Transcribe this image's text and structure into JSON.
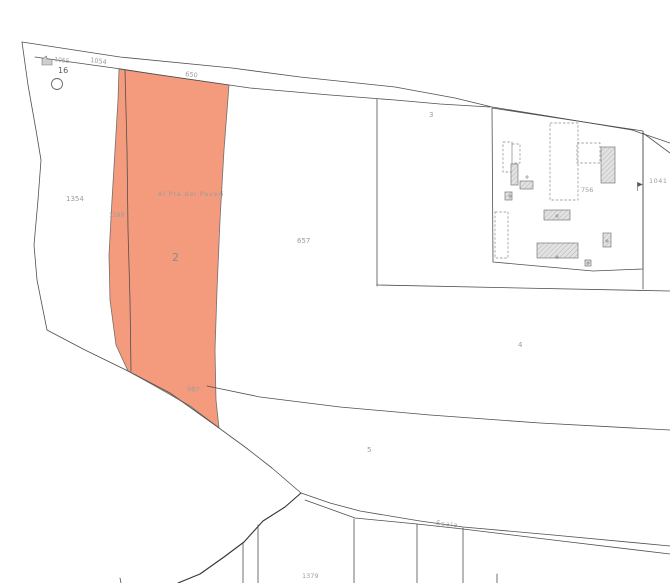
{
  "map": {
    "kind": "cadastral-parcel-map",
    "selected_parcel": "2",
    "toponym": "Al Pra del Paveri",
    "road_name": "Scala",
    "labels": {
      "p1055": "1055",
      "p16": "16",
      "p1054": "1054",
      "p650": "650",
      "p1354": "1354",
      "p1199": "1199",
      "p2": "2",
      "toponym": "Al Pra del Paveri",
      "p657": "657",
      "p3": "3",
      "p756": "756",
      "p1041": "1041",
      "p4": "4",
      "p5": "5",
      "p987": "987",
      "road": "Scala",
      "p1379": "1379"
    },
    "colors": {
      "highlight_fill": "#f49a7d",
      "boundary_line": "#4f4f4f",
      "label_text": "#9c9c9c",
      "building_fill": "#e2e2e2",
      "building_stroke": "#7a7a7a"
    },
    "icons": {
      "circle_marker": "survey point circle",
      "small_building_icon": "small building footprint",
      "survey_marker_icon": "flag marker"
    }
  }
}
